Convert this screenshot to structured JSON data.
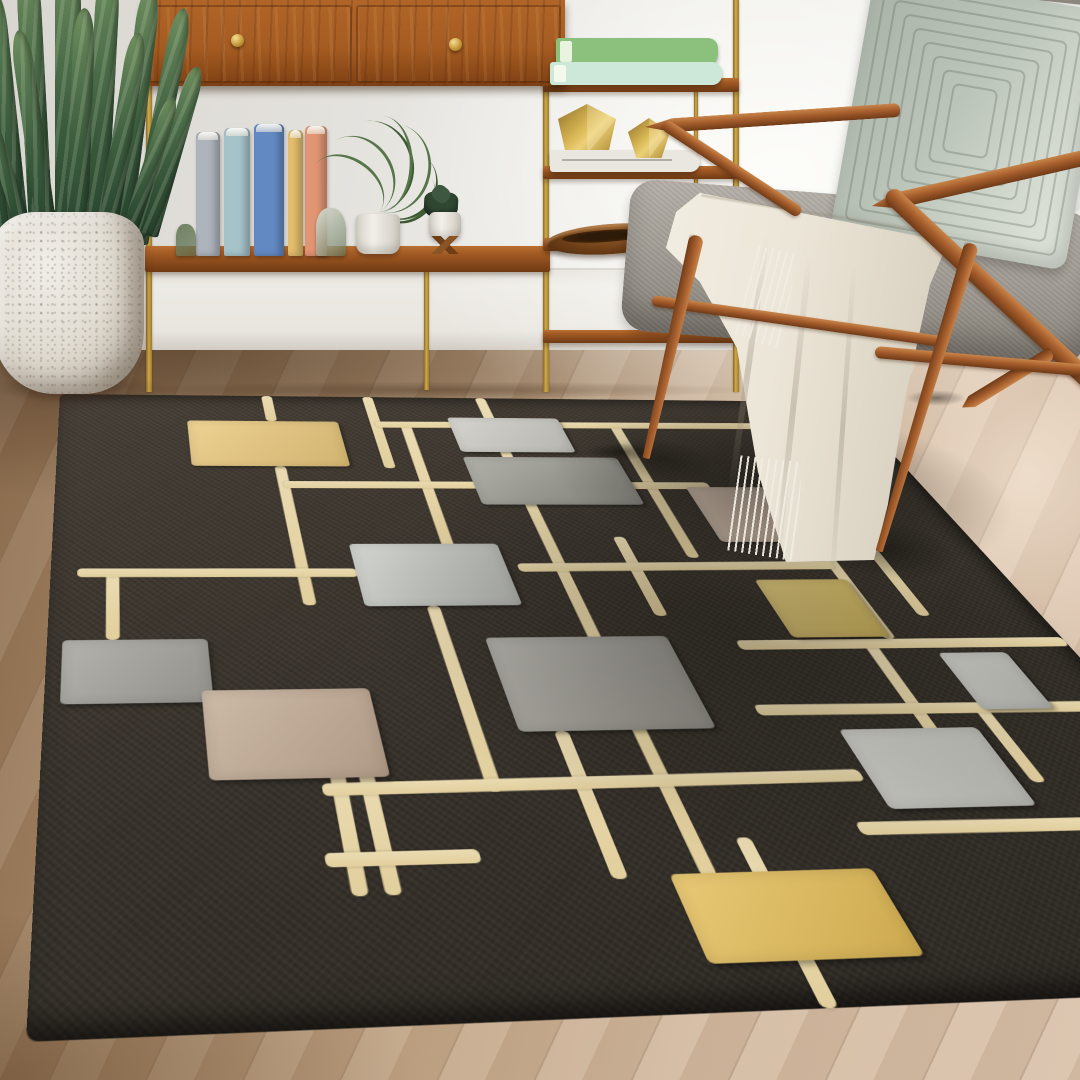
{
  "scene": {
    "width": 1080,
    "height": 1080,
    "description": "living-room-photo"
  },
  "palette": {
    "wall": "#e8e6e1",
    "baseboard": "#eae7e1",
    "floor_light": "#d5bda5",
    "floor_dark": "#8e6f51",
    "rug_field": "#352f28",
    "rug_line": "#e6d3a6",
    "rug_yellow": "#e9c87c",
    "rug_gray": "#9c9c94",
    "rug_silver": "#cbcac4",
    "rug_taupe": "#c9b39e",
    "wood_walnut": "#a55d2c",
    "brass": "#cfa94e",
    "cushion_gray": "#9d9890",
    "pillow_sage": "#bcc5ba",
    "blanket_ivory": "#ece6d8",
    "plant_green": "#3c5c3e"
  },
  "rug": {
    "plane_w": 1000,
    "plane_h": 800,
    "corners": [
      [
        60,
        394
      ],
      [
        845,
        402
      ],
      [
        1381,
        985
      ],
      [
        26,
        1042
      ]
    ],
    "line_thickness": 13,
    "vlines": [
      {
        "x": 250,
        "segs": [
          [
            0,
            55
          ],
          [
            146,
            376
          ]
        ]
      },
      {
        "x": 375,
        "segs": [
          [
            0,
            149
          ]
        ]
      },
      {
        "x": 410,
        "segs": [
          [
            63,
            296
          ]
        ]
      },
      {
        "x": 520,
        "segs": [
          [
            0,
            690
          ]
        ]
      },
      {
        "x": 599,
        "segs": [
          [
            272,
            395
          ]
        ]
      },
      {
        "x": 670,
        "segs": [
          [
            58,
            307
          ]
        ]
      },
      {
        "x": 818,
        "segs": [
          [
            281,
            430
          ]
        ]
      },
      {
        "x": 874,
        "segs": [
          [
            281,
            398
          ]
        ]
      },
      {
        "x": 60,
        "segs": [
          [
            327,
            421
          ]
        ]
      },
      {
        "x": 373,
        "segs": [
          [
            378,
            604
          ]
        ]
      },
      {
        "x": 450,
        "segs": [
          [
            540,
            690
          ]
        ]
      },
      {
        "x": 244,
        "segs": [
          [
            581,
            698
          ]
        ]
      },
      {
        "x": 269,
        "segs": [
          [
            581,
            698
          ]
        ]
      },
      {
        "x": 565,
        "segs": [
          [
            655,
            800
          ]
        ]
      },
      {
        "x": 793,
        "segs": [
          [
            436,
            613
          ]
        ]
      },
      {
        "x": 856,
        "segs": [
          [
            520,
            607
          ]
        ]
      }
    ],
    "hlines": [
      {
        "y": 58,
        "segs": [
          [
            375,
            1000
          ]
        ]
      },
      {
        "y": 180,
        "segs": [
          [
            250,
            740
          ]
        ]
      },
      {
        "y": 327,
        "segs": [
          [
            26,
            306
          ]
        ]
      },
      {
        "y": 320,
        "segs": [
          [
            475,
            818
          ]
        ]
      },
      {
        "y": 436,
        "segs": [
          [
            660,
            1000
          ]
        ]
      },
      {
        "y": 520,
        "segs": [
          [
            640,
            1000
          ]
        ]
      },
      {
        "y": 596,
        "segs": [
          [
            230,
            700
          ]
        ]
      },
      {
        "y": 665,
        "segs": [
          [
            222,
            345
          ]
        ]
      },
      {
        "y": 650,
        "segs": [
          [
            668,
            1000
          ]
        ]
      }
    ],
    "squares": [
      {
        "name": "butter-yellow",
        "x": 150,
        "y": 55,
        "w": 180,
        "h": 91,
        "c": "#e9c87c"
      },
      {
        "name": "silver",
        "x": 466,
        "y": 44,
        "w": 138,
        "h": 72,
        "c": "#cbcac4"
      },
      {
        "name": "gray",
        "x": 465,
        "y": 126,
        "w": 185,
        "h": 90,
        "c": "#9c9c94"
      },
      {
        "name": "taupe",
        "x": 711,
        "y": 183,
        "w": 168,
        "h": 98,
        "c": "#c9b39e"
      },
      {
        "name": "light-gray",
        "x": 305,
        "y": 283,
        "w": 158,
        "h": 95,
        "c": "#c6c8c2"
      },
      {
        "name": "gold",
        "x": 720,
        "y": 342,
        "w": 100,
        "h": 85,
        "c": "#d9be63"
      },
      {
        "name": "slate-gray",
        "x": 14,
        "y": 421,
        "w": 134,
        "h": 79,
        "c": "#a3a29b"
      },
      {
        "name": "khaki-taupe",
        "x": 138,
        "y": 486,
        "w": 151,
        "h": 100,
        "c": "#c2ab94"
      },
      {
        "name": "stone-gray",
        "x": 413,
        "y": 423,
        "w": 180,
        "h": 117,
        "c": "#a19f97"
      },
      {
        "name": "silver-2",
        "x": 706,
        "y": 544,
        "w": 132,
        "h": 87,
        "c": "#c9c9c3"
      },
      {
        "name": "mustard",
        "x": 491,
        "y": 687,
        "w": 168,
        "h": 76,
        "c": "#e4bd58"
      },
      {
        "name": "silver-3",
        "x": 857,
        "y": 450,
        "w": 71,
        "h": 73,
        "c": "#c4c4be"
      }
    ],
    "shadows": [
      {
        "cx": 830,
        "cy": 170,
        "rx": 270,
        "ry": 170,
        "o": 0.45
      },
      {
        "cx": 660,
        "cy": 410,
        "rx": 360,
        "ry": 290,
        "o": 0.28
      },
      {
        "cx": 889,
        "cy": 292,
        "rx": 80,
        "ry": 52,
        "o": 0.4
      },
      {
        "cx": 700,
        "cy": 128,
        "rx": 66,
        "ry": 44,
        "o": 0.38
      }
    ]
  },
  "plant": {
    "leaves": [
      {
        "x": 8,
        "y": -12,
        "w": 22,
        "h": 252,
        "rot": -6
      },
      {
        "x": 30,
        "y": -34,
        "w": 24,
        "h": 282,
        "rot": -3
      },
      {
        "x": 55,
        "y": -42,
        "w": 26,
        "h": 300,
        "rot": 0
      },
      {
        "x": 82,
        "y": -32,
        "w": 24,
        "h": 286,
        "rot": 3
      },
      {
        "x": 108,
        "y": -16,
        "w": 22,
        "h": 262,
        "rot": 7
      },
      {
        "x": 128,
        "y": 4,
        "w": 20,
        "h": 240,
        "rot": 11
      },
      {
        "x": 0,
        "y": 58,
        "w": 18,
        "h": 182,
        "rot": -14
      },
      {
        "x": 140,
        "y": 60,
        "w": 18,
        "h": 176,
        "rot": 16
      },
      {
        "x": 40,
        "y": 28,
        "w": 20,
        "h": 222,
        "rot": -8
      },
      {
        "x": 95,
        "y": 30,
        "w": 20,
        "h": 216,
        "rot": 9
      },
      {
        "x": 65,
        "y": 8,
        "w": 22,
        "h": 250,
        "rot": 2
      },
      {
        "x": 20,
        "y": 88,
        "w": 16,
        "h": 152,
        "rot": -18
      },
      {
        "x": 118,
        "y": 90,
        "w": 16,
        "h": 152,
        "rot": 18
      }
    ]
  },
  "shelf": {
    "legs": [
      {
        "x": 146,
        "y": 84,
        "h": 308,
        "w": 6
      },
      {
        "x": 424,
        "y": 268,
        "h": 122,
        "w": 5
      },
      {
        "x": 543,
        "y": 0,
        "h": 392,
        "w": 6
      },
      {
        "x": 733,
        "y": 0,
        "h": 392,
        "w": 6
      },
      {
        "x": 694,
        "y": 88,
        "h": 104,
        "w": 4
      }
    ],
    "boards": [
      {
        "x": 145,
        "y": 246,
        "w": 405,
        "h": 26
      },
      {
        "x": 543,
        "y": 78,
        "w": 196,
        "h": 14
      },
      {
        "x": 543,
        "y": 166,
        "w": 196,
        "h": 13
      },
      {
        "x": 543,
        "y": 238,
        "w": 196,
        "h": 13
      },
      {
        "x": 543,
        "y": 330,
        "w": 196,
        "h": 13
      }
    ],
    "cabinet": {
      "x": 143,
      "y": 0,
      "w": 422,
      "h": 86,
      "divider": 352,
      "knobs": [
        [
          237,
          40
        ],
        [
          455,
          44
        ]
      ]
    },
    "books": [
      {
        "x": 196,
        "y": 132,
        "w": 24,
        "h": 124,
        "c": "#aeb4bc"
      },
      {
        "x": 224,
        "y": 128,
        "w": 26,
        "h": 128,
        "c": "#a6c3ca"
      },
      {
        "x": 254,
        "y": 124,
        "w": 30,
        "h": 132,
        "c": "#6389c2"
      },
      {
        "x": 288,
        "y": 130,
        "w": 15,
        "h": 126,
        "c": "#e5be6d"
      },
      {
        "x": 305,
        "y": 126,
        "w": 22,
        "h": 130,
        "c": "#e19573"
      }
    ],
    "bookends": [
      {
        "x": 176,
        "y": 224,
        "w": 20,
        "h": 32,
        "c": "#6f8160"
      },
      {
        "x": 316,
        "y": 208,
        "w": 30,
        "h": 48,
        "c": "#d9dacd"
      }
    ],
    "green_books": [
      {
        "x": 556,
        "y": 38,
        "w": 162,
        "h": 27,
        "c": "#8cc17d"
      },
      {
        "x": 550,
        "y": 62,
        "w": 172,
        "h": 23,
        "c": "#cde8d9"
      }
    ],
    "white_book": {
      "x": 550,
      "y": 150,
      "w": 150,
      "h": 22,
      "c": "#eae7e0"
    },
    "geos": [
      {
        "x": 558,
        "y": 104,
        "w": 58,
        "h": 50,
        "clip": "polygon(50% 0,100% 30%,88% 92%,12% 92%,0 30%)"
      },
      {
        "x": 628,
        "y": 118,
        "w": 42,
        "h": 40,
        "clip": "polygon(50% 0,100% 35%,80% 100%,20% 100%,0 35%)"
      }
    ],
    "palm": {
      "cx": 378,
      "cy": 212,
      "pot": {
        "x": 356,
        "y": 214,
        "w": 44,
        "h": 40
      },
      "fronds": [
        {
          "w": 70,
          "h": 84,
          "rot": -32
        },
        {
          "w": 82,
          "h": 92,
          "rot": -10
        },
        {
          "w": 78,
          "h": 90,
          "rot": 14
        },
        {
          "w": 66,
          "h": 72,
          "rot": 40
        },
        {
          "w": 58,
          "h": 80,
          "rot": -54
        },
        {
          "w": 50,
          "h": 62,
          "rot": 58
        },
        {
          "w": 60,
          "h": 96,
          "rot": 2
        }
      ]
    },
    "succulent": {
      "x": 424,
      "y": 192,
      "pot": {
        "x": 429,
        "y": 212,
        "w": 32,
        "h": 28
      }
    },
    "bowl": {
      "x": 546,
      "y": 224,
      "w": 132,
      "h": 30
    }
  },
  "chair": {
    "wood": [
      {
        "name": "armrest-right",
        "x1": 872,
        "y1": 206,
        "x2": 1092,
        "y2": 156,
        "w": 16,
        "tip": "left"
      },
      {
        "name": "rear-diagonal-right",
        "x1": 888,
        "y1": 192,
        "x2": 1118,
        "y2": 408,
        "w": 18
      },
      {
        "name": "rear-leg-right",
        "x1": 1052,
        "y1": 352,
        "x2": 962,
        "y2": 407,
        "w": 13,
        "tip": "right"
      },
      {
        "name": "seat-rail-right",
        "x1": 875,
        "y1": 352,
        "x2": 1090,
        "y2": 371,
        "w": 12
      },
      {
        "name": "seat-rail-left",
        "x1": 652,
        "y1": 300,
        "x2": 948,
        "y2": 342,
        "w": 11
      },
      {
        "name": "front-leg-right",
        "x1": 972,
        "y1": 243,
        "x2": 879,
        "y2": 551,
        "w": 15,
        "taper": true
      },
      {
        "name": "armrest-left",
        "x1": 645,
        "y1": 127,
        "x2": 900,
        "y2": 110,
        "w": 14,
        "tip": "left"
      },
      {
        "name": "arm-support-left",
        "x1": 664,
        "y1": 124,
        "x2": 800,
        "y2": 213,
        "w": 12
      },
      {
        "name": "front-leg-left",
        "x1": 697,
        "y1": 235,
        "x2": 646,
        "y2": 458,
        "w": 15,
        "taper": true
      }
    ],
    "seat": {
      "x": 625,
      "y": 196,
      "w": 465,
      "h": 152,
      "rot": 4.5
    },
    "back_cushion": {
      "x": 915,
      "y": -20,
      "w": 185,
      "h": 95,
      "rot": -16
    },
    "white_pillow": {
      "x": 1004,
      "y": 2,
      "w": 92,
      "h": 210,
      "rot": 6
    },
    "sage_pillow": {
      "x": 851,
      "y": -10,
      "w": 238,
      "h": 262,
      "rot": 10,
      "rings": 8
    },
    "contacts": [
      [
        620,
        452,
        70,
        18
      ],
      [
        850,
        542,
        74,
        20
      ],
      [
        936,
        398,
        60,
        16
      ]
    ]
  },
  "blanket": {
    "box": {
      "x": 640,
      "y": 180,
      "w": 340,
      "h": 400
    },
    "poly": [
      [
        17.6,
        3.2
      ],
      [
        90.6,
        15.5
      ],
      [
        85.3,
        26.2
      ],
      [
        78.2,
        53.8
      ],
      [
        72.9,
        81.2
      ],
      [
        68.8,
        95.0
      ],
      [
        42.9,
        95.5
      ],
      [
        34.7,
        73.0
      ],
      [
        28.5,
        42.0
      ],
      [
        17.6,
        25.5
      ],
      [
        7.6,
        17.0
      ],
      [
        10.6,
        8.0
      ]
    ],
    "folds": [
      {
        "x": 105,
        "y": 55,
        "w": 6,
        "h": 270,
        "rot": 8
      },
      {
        "x": 150,
        "y": 75,
        "w": 6,
        "h": 310,
        "rot": 6
      },
      {
        "x": 200,
        "y": 85,
        "w": 5,
        "h": 330,
        "rot": 4
      },
      {
        "x": 60,
        "y": 30,
        "w": 220,
        "h": 5,
        "rot": 9
      }
    ],
    "fringes": [
      {
        "x": 88,
        "y": 278,
        "w": 72,
        "h": 104,
        "rot": 6
      },
      {
        "x": 100,
        "y": 68,
        "w": 50,
        "h": 100,
        "rot": 13
      }
    ]
  }
}
